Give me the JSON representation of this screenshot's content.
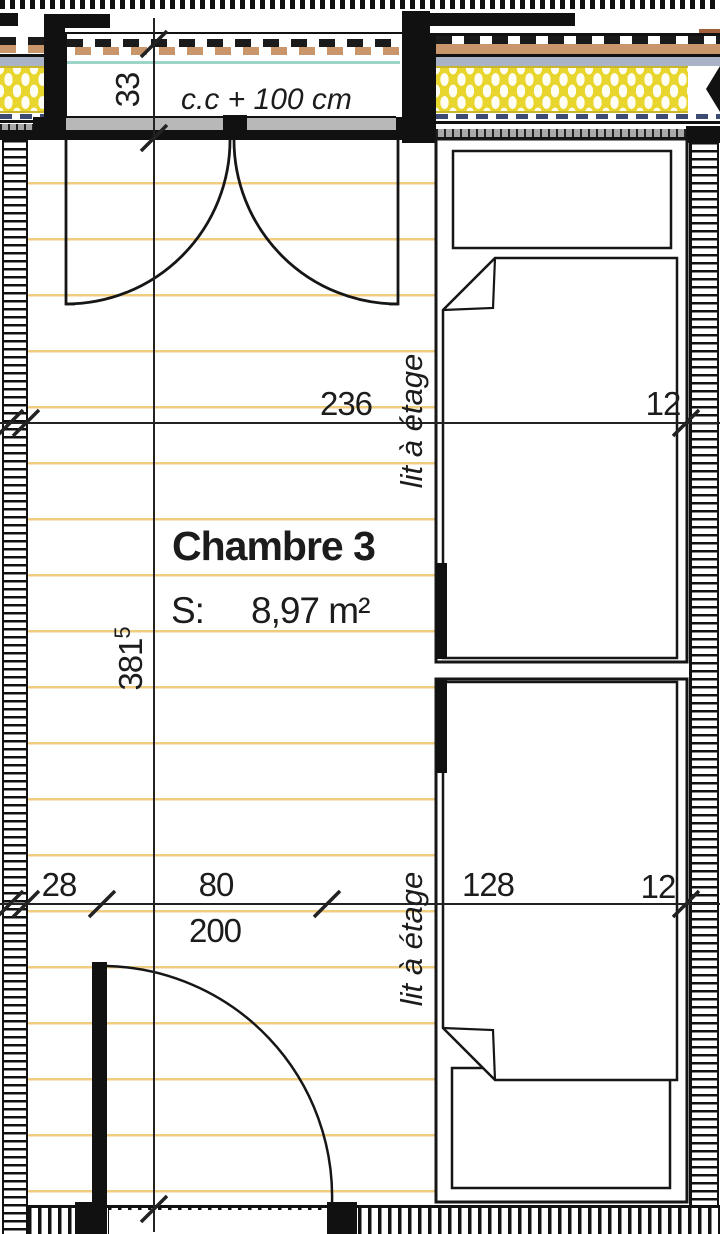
{
  "room": {
    "title": "Chambre 3",
    "surface_label": "S:",
    "surface_value": "8,97 m²"
  },
  "labels": {
    "window_sill": "c.c + 100 cm",
    "bunk_bed_upper": "lit à étage",
    "bunk_bed_lower": "lit à étage"
  },
  "dimensions": {
    "room_width_cm": "236",
    "right_wall_top_cm": "12",
    "top_wall_thickness_cm": "33",
    "room_length_cm": "381",
    "room_length_exp": "5",
    "wall_to_door_cm": "28",
    "door_width_cm": "80",
    "door_height_cm": "200",
    "bed_zone_cm": "128",
    "right_wall_bottom_cm": "12"
  },
  "colors": {
    "floor_line": "#f0cc80",
    "insulation_yellow": "#e8d62e",
    "screed_blue": "#a9b3c6",
    "cladding_tan": "#c9956b",
    "glazing_teal": "#9dd3c8",
    "ink": "#1c1c1c"
  }
}
